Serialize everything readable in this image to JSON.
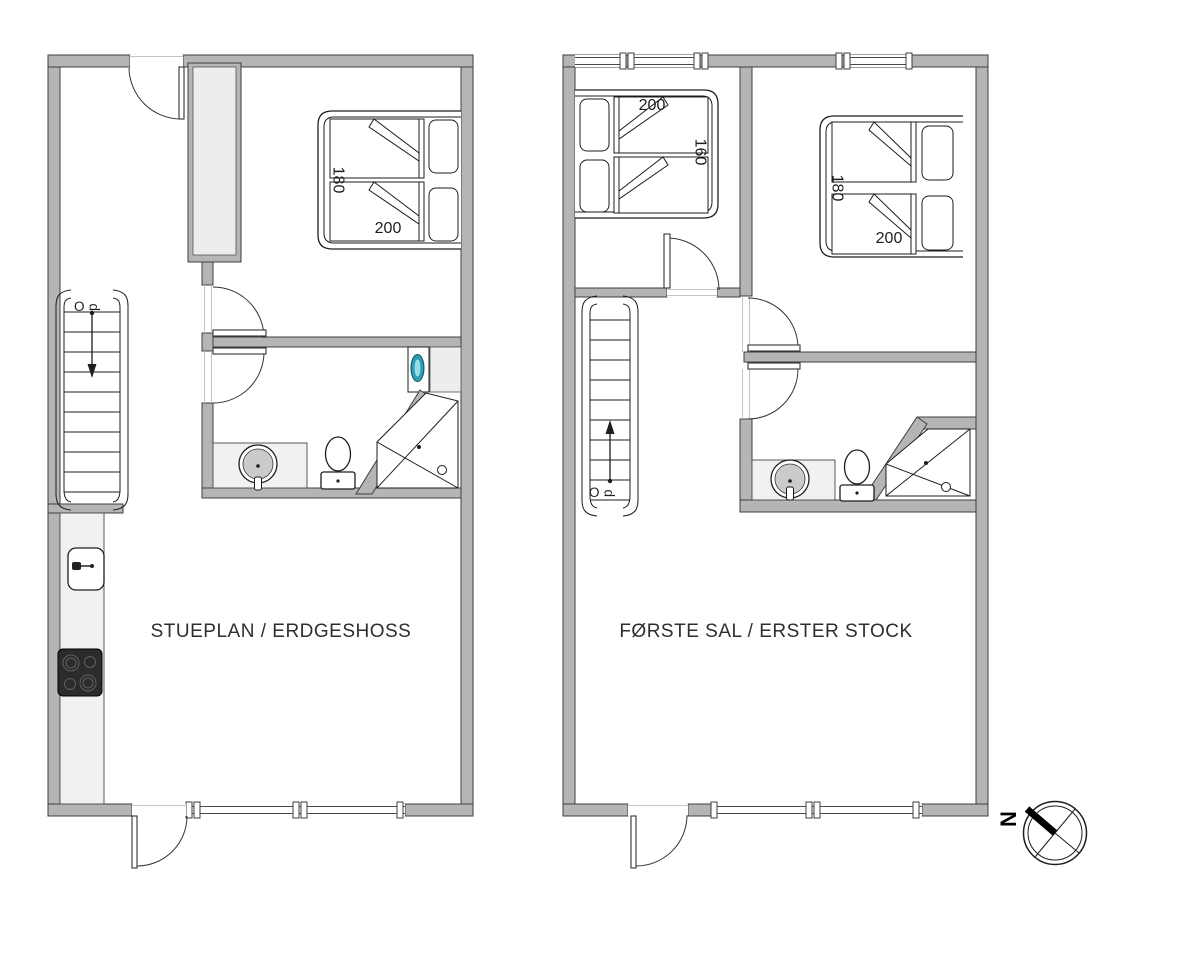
{
  "colors": {
    "wall_fill": "#b5b5b5",
    "wall_stroke": "#3f3f3f",
    "line": "#1d1d1d",
    "light_fill": "#ededed",
    "washer_drum": "#2d9db3",
    "stove_fill": "#2b2b2b",
    "text_color": "#2e2e2e"
  },
  "ground_floor": {
    "title": "STUEPLAN / ERDGESHOSS",
    "stairs_direction_label": "Op",
    "bedroom_bed": {
      "width_cm": "180",
      "length_cm": "200"
    },
    "fixtures": [
      "staircase",
      "wardrobe",
      "double-bed",
      "washing-machine",
      "shower",
      "toilet",
      "washbasin",
      "kitchen-sink",
      "stove"
    ]
  },
  "first_floor": {
    "title": "FØRSTE SAL / ERSTER STOCK",
    "stairs_direction_label": "Op",
    "bedroom_small_bed": {
      "length_cm": "200",
      "width_cm": "160"
    },
    "bedroom_large_bed": {
      "width_cm": "180",
      "length_cm": "200"
    },
    "fixtures": [
      "staircase",
      "double-bed",
      "double-bed",
      "shower",
      "toilet",
      "washbasin"
    ]
  },
  "compass": {
    "north_label": "N"
  }
}
